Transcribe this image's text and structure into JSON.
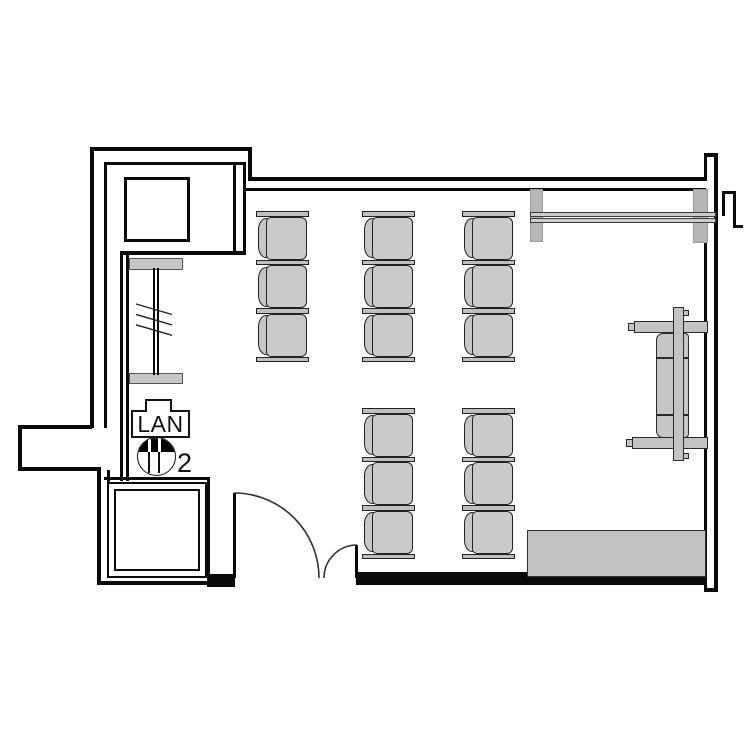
{
  "title": "room-floor-plan",
  "labels": {
    "lan": "LAN",
    "door_count": "2"
  },
  "colors": {
    "wall": "#0a0a0a",
    "furniture_fill": "#c8c8c8",
    "furniture_stroke": "#2a2a2a",
    "counter_fill": "#c2c2c2",
    "background": "#ffffff"
  },
  "plan": {
    "desk_unit": {
      "bar_w": 53,
      "bar_h": 5.5,
      "chair_w": 49,
      "chair_h": 43,
      "pitch": 48.5
    },
    "desk_groups": [
      {
        "id": "top-desk-block",
        "cols_x": [
          256,
          362,
          462
        ],
        "y": 211,
        "rows": 3
      },
      {
        "id": "bottom-desk-block",
        "cols_x": [
          362,
          462
        ],
        "y": 408,
        "rows": 3
      }
    ]
  }
}
